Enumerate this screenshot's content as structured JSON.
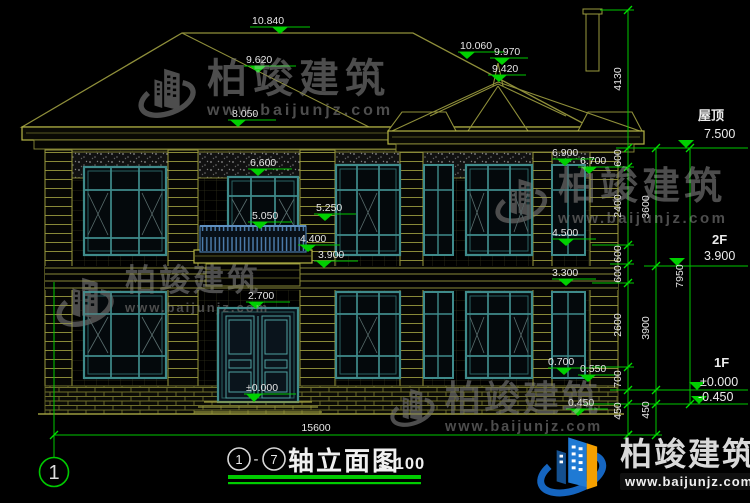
{
  "title": {
    "axis_start": "1",
    "dash": "-",
    "axis_end": "7",
    "name": "轴立面图",
    "scale": "1:100"
  },
  "axis_bubble_left": "1",
  "total_width_dim": "15600",
  "markers": [
    "10.840",
    "9.620",
    "8.050",
    "10.060",
    "9.970",
    "9.420",
    "6.600",
    "5.050",
    "5.250",
    "4.400",
    "3.900",
    "2.700",
    "±0.000",
    "6.900",
    "6.700",
    "4.500",
    "3.300",
    "0.700",
    "0.550",
    "0.450"
  ],
  "chain_a": [
    "4130",
    "600",
    "2400",
    "600",
    "600",
    "2600",
    "700",
    "450"
  ],
  "chain_b": [
    "3600",
    "3900",
    "450"
  ],
  "chain_c": [
    "7950"
  ],
  "levels": {
    "roof": {
      "label": "屋顶",
      "value": "7.500"
    },
    "f2": {
      "label": "2F",
      "value": "3.900"
    },
    "f1": {
      "label": "1F",
      "value": "±0.000"
    },
    "ground": {
      "value": "-0.450"
    }
  },
  "watermark": {
    "brand": "柏竣建筑",
    "url": "www.baijunjz.com"
  },
  "colors": {
    "dim_green": "#00c800",
    "cad_yellow": "#8a8a38",
    "window_teal": "#3f8b8b",
    "text_white": "#e6e6e6",
    "logo_blue": "#1f7ad4",
    "logo_orange": "#f5a000"
  }
}
